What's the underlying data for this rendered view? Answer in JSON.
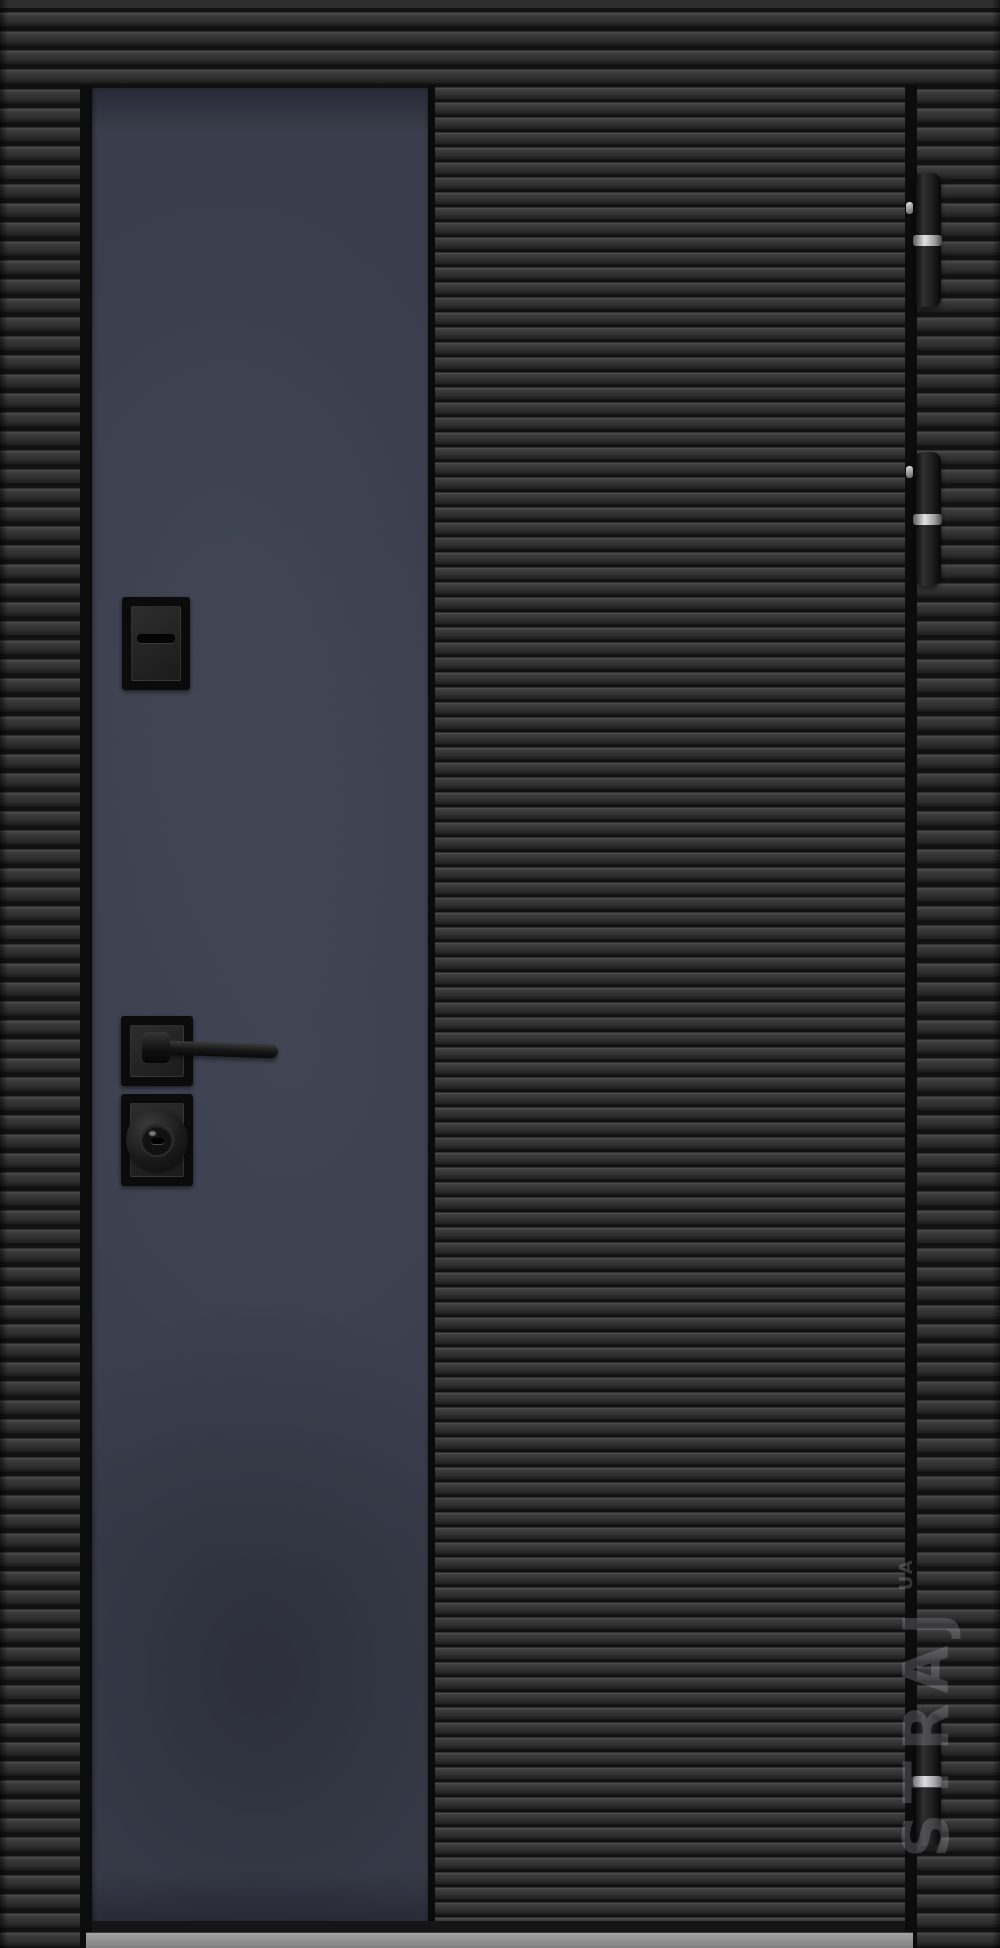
{
  "image": {
    "type": "product-photo",
    "subject": "Matte black entrance door with horizontal ribbed milling and a dark navy vertical insert panel",
    "hinge_side": "right",
    "hinge_count": 3
  },
  "door": {
    "leaf_texture": "horizontal-ribbed",
    "frame_texture": "horizontal-ribbed",
    "panel_color": "#3a3e4c",
    "body_color": "#2b2b2b",
    "groove_color": "#101010",
    "hardware_finish": "matte-black",
    "hinge_ring_color": "#d9d9d9",
    "threshold_color": "#8f8f8f",
    "hardware_items": [
      "thumbturn-lock",
      "lever-handle",
      "cylinder-escutcheon"
    ]
  },
  "watermark": {
    "text": "STRAJ",
    "suffix": "UA",
    "color": "#c8c8c8"
  }
}
